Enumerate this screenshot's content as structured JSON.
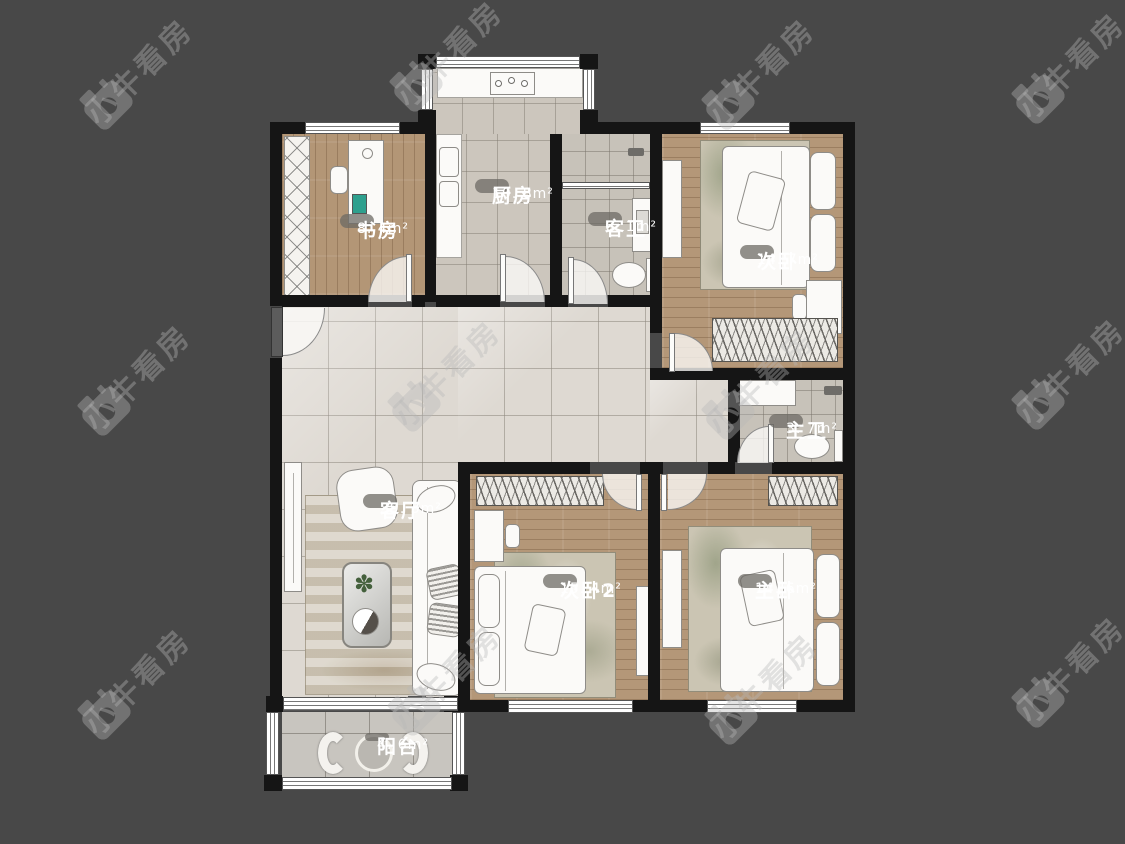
{
  "watermark": {
    "text": "小牛看房"
  },
  "rooms": {
    "study": {
      "name": "书房",
      "area": "8. 4m²"
    },
    "kitchen": {
      "name": "厨房",
      "area": "10. 8m²"
    },
    "guest_bath": {
      "name": "客卫",
      "area": "6. 1m²"
    },
    "bedroom_top": {
      "name": "次卧",
      "area": "14. 7m²"
    },
    "master_bath": {
      "name": "主卫",
      "area": "3. 7m²"
    },
    "living_room": {
      "name": "客厅",
      "area": "39. 3m²"
    },
    "bedroom_2": {
      "name": "次卧2",
      "area": "15. 4m²"
    },
    "master_bedroom": {
      "name": "主卧",
      "area": "14. 6m²"
    },
    "balcony": {
      "name": "阳台",
      "area": "4. 6m²"
    }
  },
  "icons": {
    "plant": "✽"
  },
  "colors": {
    "background": "#484848",
    "wall": "#151515",
    "wood_floor": "#b39676",
    "tile_floor": "#ded9d2",
    "label_bubble": "#6c6964",
    "watermark": "#b9b9b9"
  }
}
